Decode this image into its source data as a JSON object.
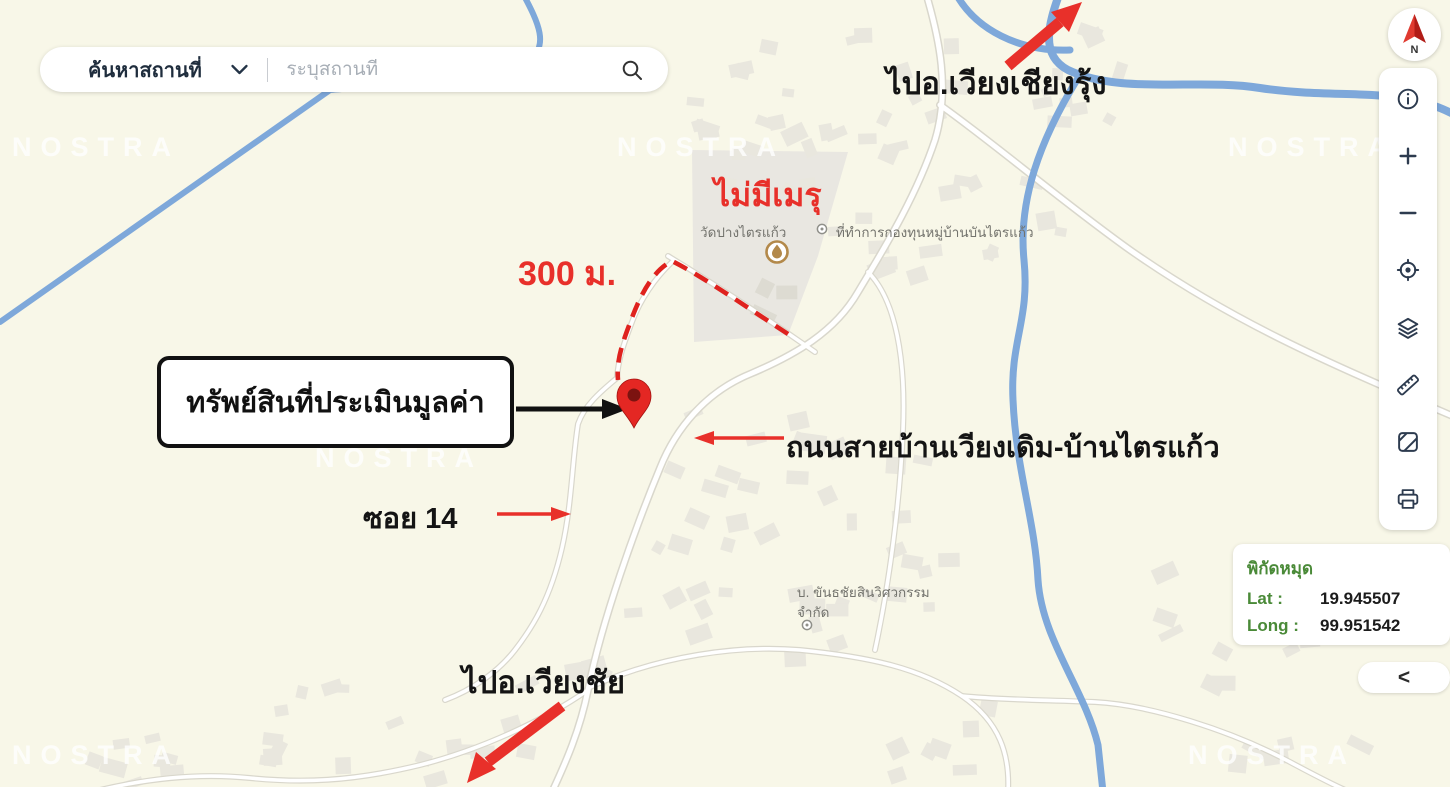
{
  "search": {
    "category": "ค้นหาสถานที่",
    "placeholder": "ระบุสถานที่"
  },
  "compass": {
    "north": "N"
  },
  "toolbar": {
    "buttons": [
      "info",
      "zoom-in",
      "zoom-out",
      "locate",
      "layers",
      "measure",
      "basemap",
      "print"
    ]
  },
  "annotations": {
    "to_wiang_chiang_rung": "ไปอ.เวียงเชียงรุ้ง",
    "no_crematorium": "ไม่มีเมรุ",
    "distance": "300 ม.",
    "property": "ทรัพย์สินที่ประเมินมูลค่า",
    "road": "ถนนสายบ้านเวียงเดิม-บ้านไตรแก้ว",
    "soi": "ซอย 14",
    "to_wiang_chai": "ไปอ.เวียงชัย"
  },
  "map_labels": {
    "temple": "วัดปางไตรแก้ว",
    "village_fund_office": "ที่ทำการกองทุนหมู่บ้านบันไตรแก้ว",
    "company_line1": "บ. ขันธชัยสินวิศวกรรม",
    "company_line2": "จำกัด"
  },
  "pin_panel": {
    "title": "พิกัดหมุด",
    "lat_label": "Lat :",
    "lat_value": "19.945507",
    "long_label": "Long :",
    "long_value": "99.951542"
  },
  "collapse_button": "<",
  "watermark": "NOSTRA",
  "colors": {
    "annotation_red": "#e8302a",
    "panel_green": "#4a8a38",
    "pin_red": "#e42723",
    "river_blue": "#7ea8da",
    "map_background": "#f8f7e8"
  }
}
